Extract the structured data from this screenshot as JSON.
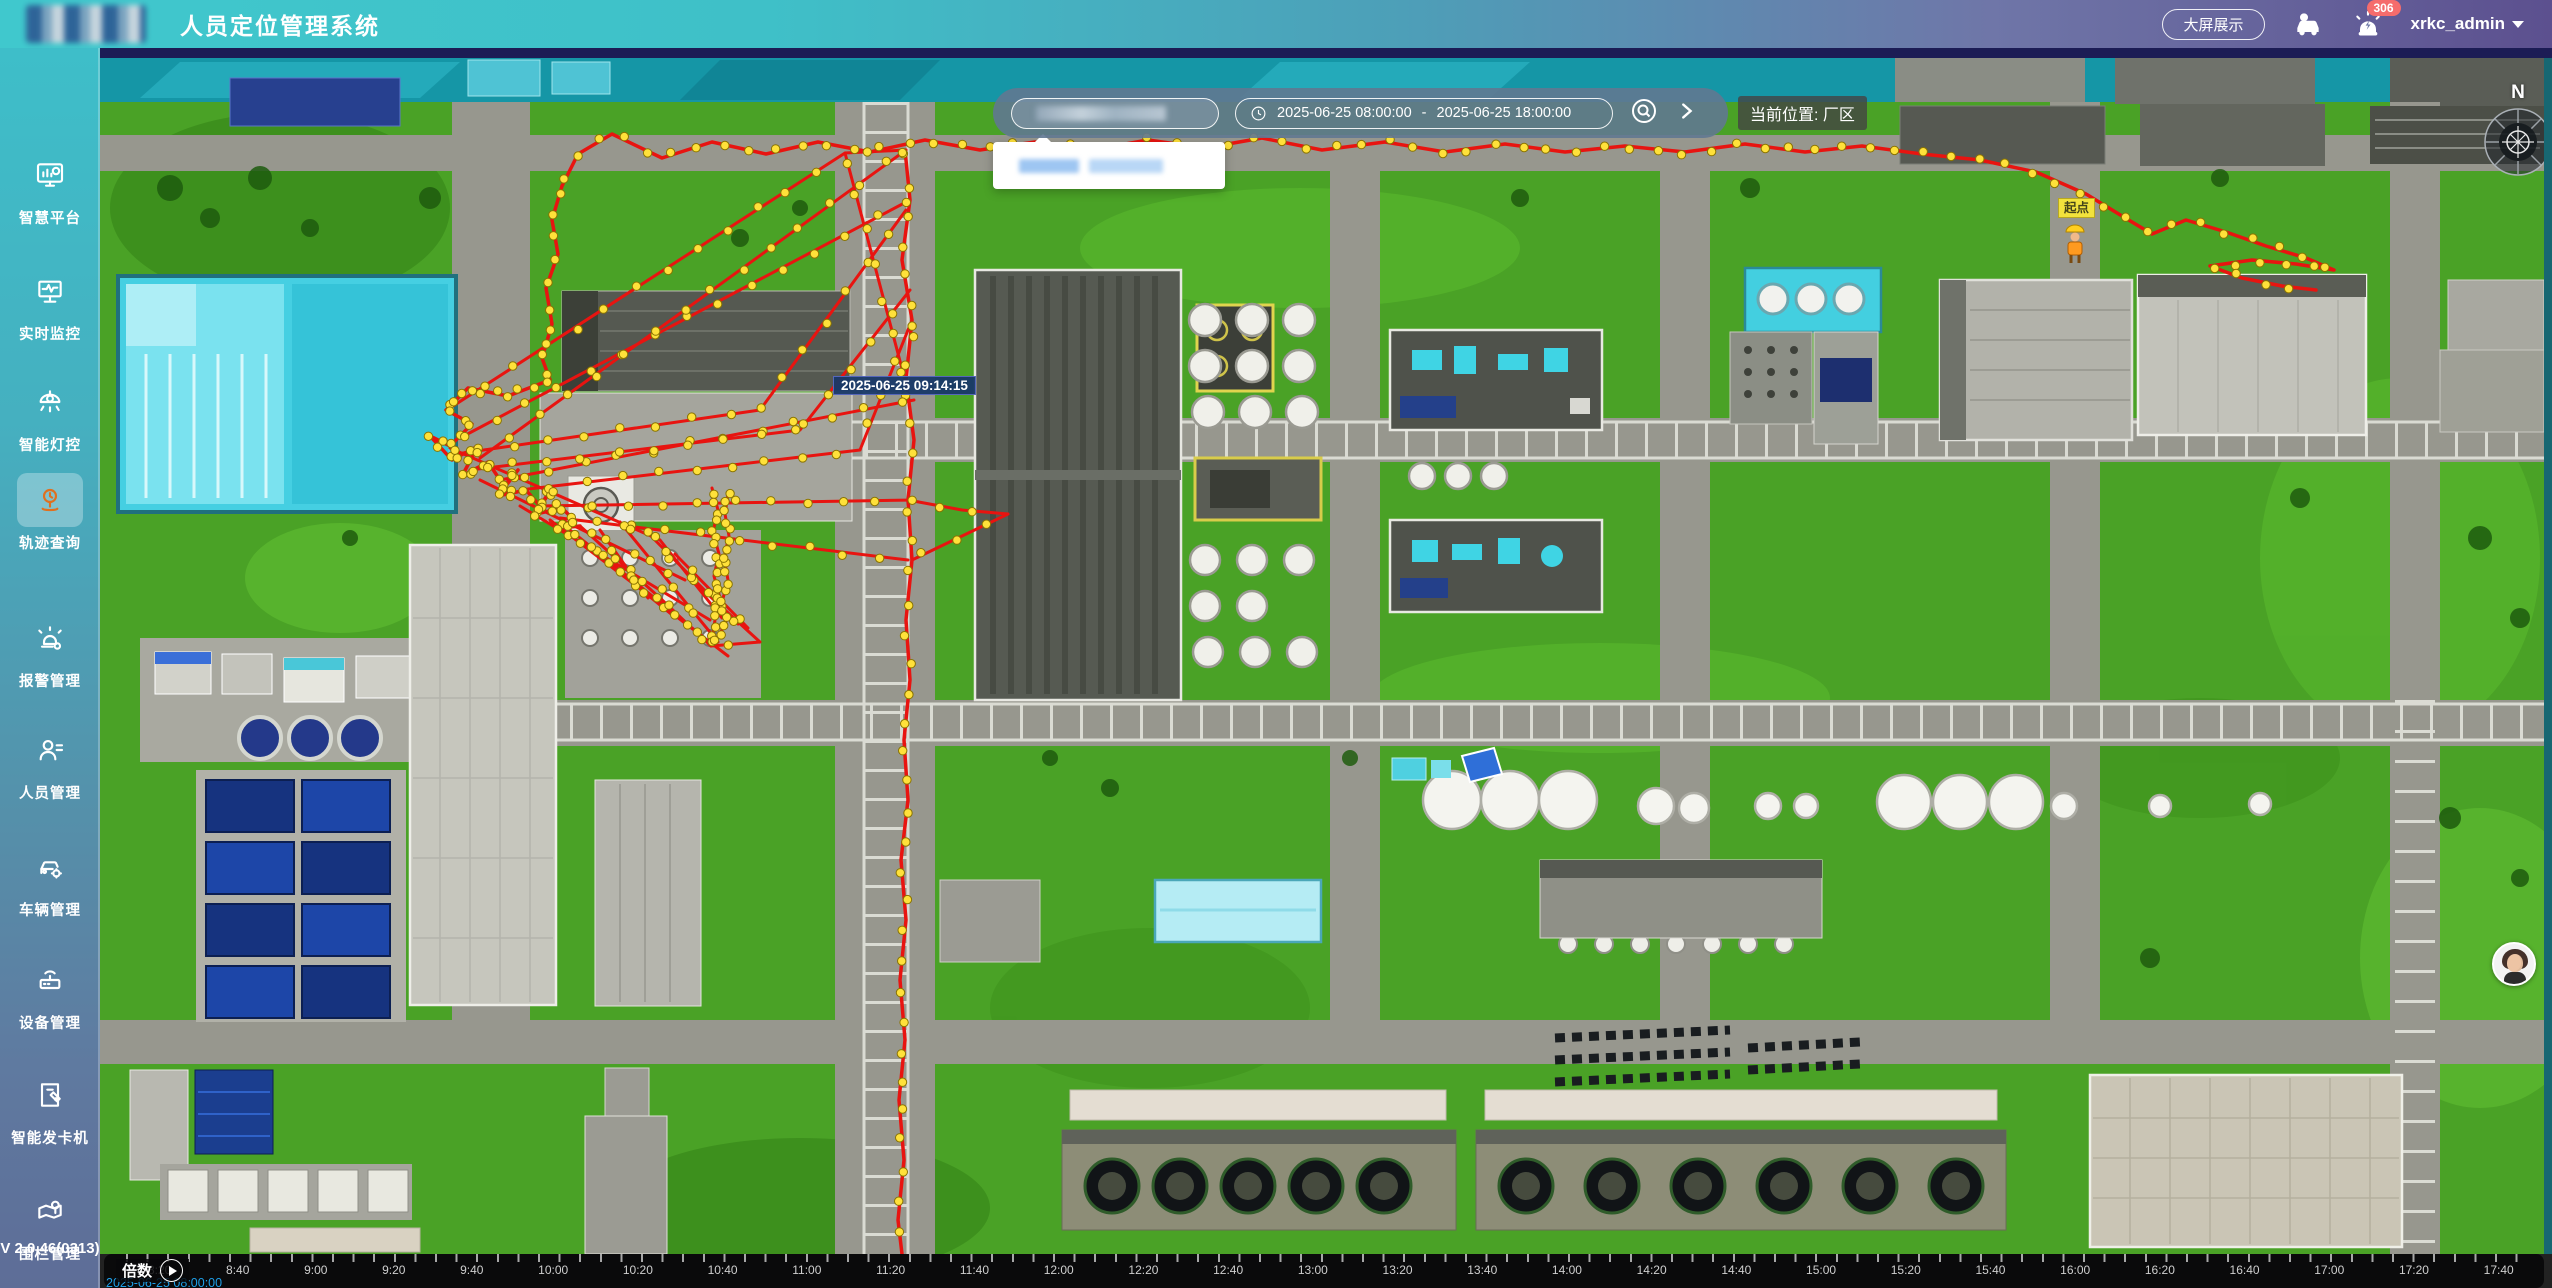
{
  "header": {
    "app_title": "人员定位管理系统",
    "big_screen_button": "大屏展示",
    "notification_count": "306",
    "username": "xrkc_admin"
  },
  "sidebar": {
    "items": [
      {
        "label": "智慧平台"
      },
      {
        "label": "实时监控"
      },
      {
        "label": "智能灯控"
      },
      {
        "label": "轨迹查询"
      },
      {
        "label": "报警管理"
      },
      {
        "label": "人员管理"
      },
      {
        "label": "车辆管理"
      },
      {
        "label": "设备管理"
      },
      {
        "label": "智能发卡机"
      },
      {
        "label": "围栏管理"
      }
    ],
    "active_item": "轨迹查询",
    "version": "V 2.0.46(0313)"
  },
  "toolbar": {
    "date_start": "2025-06-25 08:00:00",
    "date_separator": "-",
    "date_end": "2025-06-25 18:00:00",
    "current_location": "当前位置: 厂区"
  },
  "map": {
    "track_tooltip": "2025-06-25 09:14:15",
    "start_point_label": "起点",
    "compass_north": "N"
  },
  "timeline": {
    "speed_label": "倍数",
    "current_time": "2025-06-25 08:00:00",
    "ticks": [
      "8:20",
      "8:40",
      "9:00",
      "9:20",
      "9:40",
      "10:00",
      "10:20",
      "10:40",
      "11:00",
      "11:20",
      "11:40",
      "12:00",
      "12:20",
      "12:40",
      "13:00",
      "13:20",
      "13:40",
      "14:00",
      "14:20",
      "14:40",
      "15:00",
      "15:20",
      "15:40",
      "16:00",
      "16:20",
      "16:40",
      "17:00",
      "17:20",
      "17:40"
    ]
  }
}
